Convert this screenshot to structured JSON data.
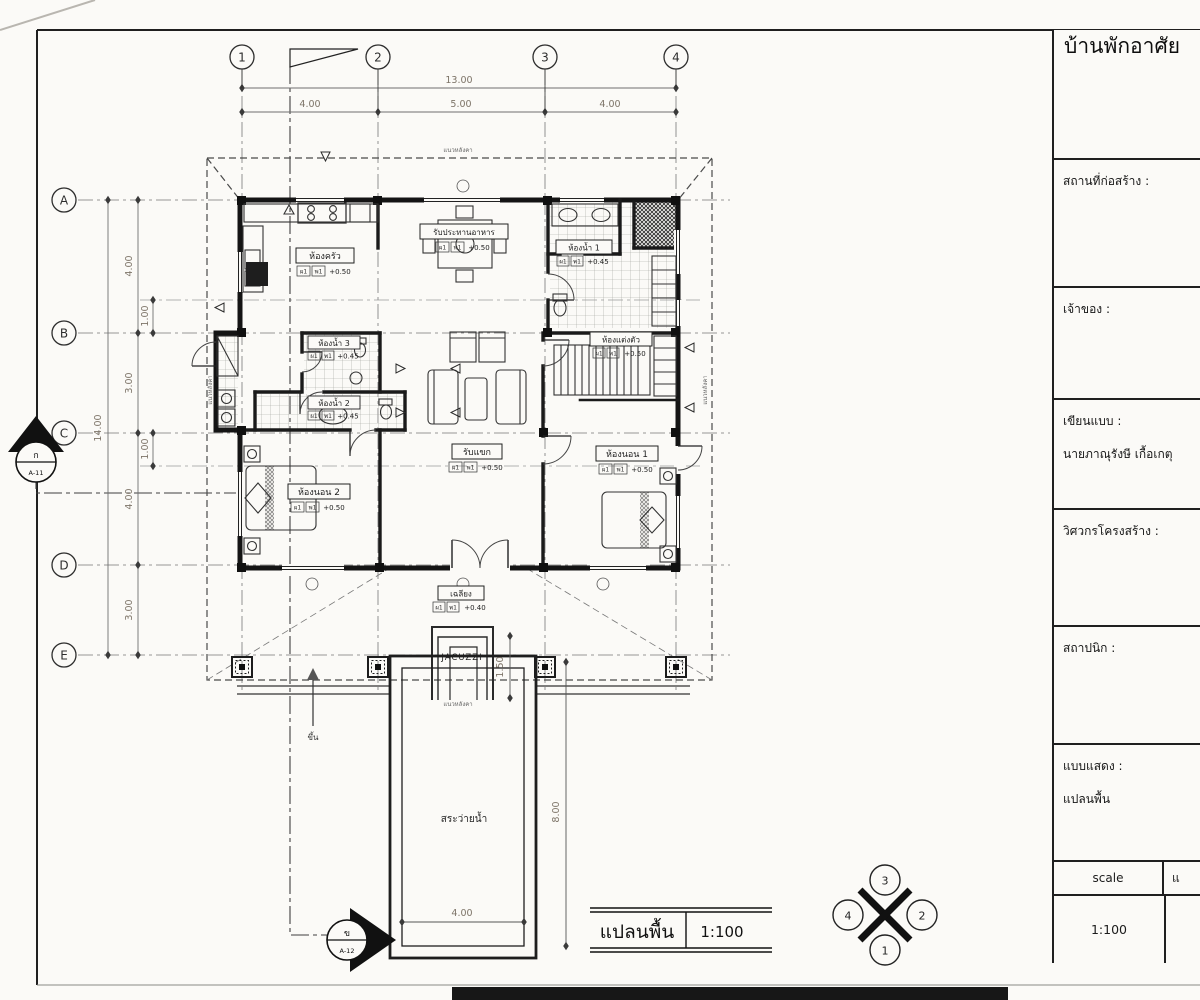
{
  "title_block": {
    "project_title": "บ้านพักอาศัย",
    "fields": [
      {
        "label": "สถานที่ก่อสร้าง :",
        "value": ""
      },
      {
        "label": "เจ้าของ :",
        "value": ""
      },
      {
        "label": "เขียนแบบ :",
        "value": "นายภาณุรังษี  เกื้อเกตุ"
      },
      {
        "label": "วิศวกรโครงสร้าง :",
        "value": ""
      },
      {
        "label": "สถาปนิก :",
        "value": ""
      },
      {
        "label": "แบบแสดง :",
        "value": "แปลนพื้น"
      }
    ],
    "scale_table": {
      "scale_header": "scale",
      "sheet_header": "แ",
      "scale_value": "1:100"
    }
  },
  "drawing_title": {
    "label": "แปลนพื้น",
    "scale": "1:100"
  },
  "grid": {
    "cols": [
      "1",
      "2",
      "3",
      "4"
    ],
    "rows": [
      "A",
      "B",
      "C",
      "D",
      "E"
    ]
  },
  "dims": {
    "top_total": "13.00",
    "top": [
      "4.00",
      "5.00",
      "4.00"
    ],
    "left_total": "14.00",
    "left": [
      "4.00",
      "3.00",
      "4.00",
      "3.00"
    ],
    "left_sub": [
      "1.00",
      "1.00"
    ],
    "porch": "1.50",
    "pool_w": "4.00",
    "pool_h": "8.00"
  },
  "codes": {
    "c1": "ผ1",
    "c2": "พ1"
  },
  "rooms": [
    {
      "name": "ห้องครัว",
      "level": "+0.50"
    },
    {
      "name": "รับประทานอาหาร",
      "level": "+0.50"
    },
    {
      "name": "ห้องน้ำ 1",
      "level": "+0.45"
    },
    {
      "name": "ห้องแต่งตัว",
      "level": "+0.50"
    },
    {
      "name": "ห้องน้ำ 3",
      "level": "+0.45"
    },
    {
      "name": "ห้องน้ำ 2",
      "level": "+0.45"
    },
    {
      "name": "รับแขก",
      "level": "+0.50"
    },
    {
      "name": "ห้องนอน 1",
      "level": "+0.50"
    },
    {
      "name": "ห้องนอน 2",
      "level": "+0.50"
    },
    {
      "name": "เฉลียง",
      "level": "+0.40"
    }
  ],
  "annotations": {
    "jacuzzi": "JACUZZI",
    "pool": "สระว่ายน้ำ",
    "up": "ขึ้น",
    "roof_line": "แนวหลังคา"
  },
  "markers": {
    "section_a": {
      "letter": "ก",
      "ref": "A-11"
    },
    "section_b": {
      "letter": "ข",
      "ref": "A-12"
    },
    "elev_key": [
      "1",
      "2",
      "3",
      "4"
    ]
  }
}
